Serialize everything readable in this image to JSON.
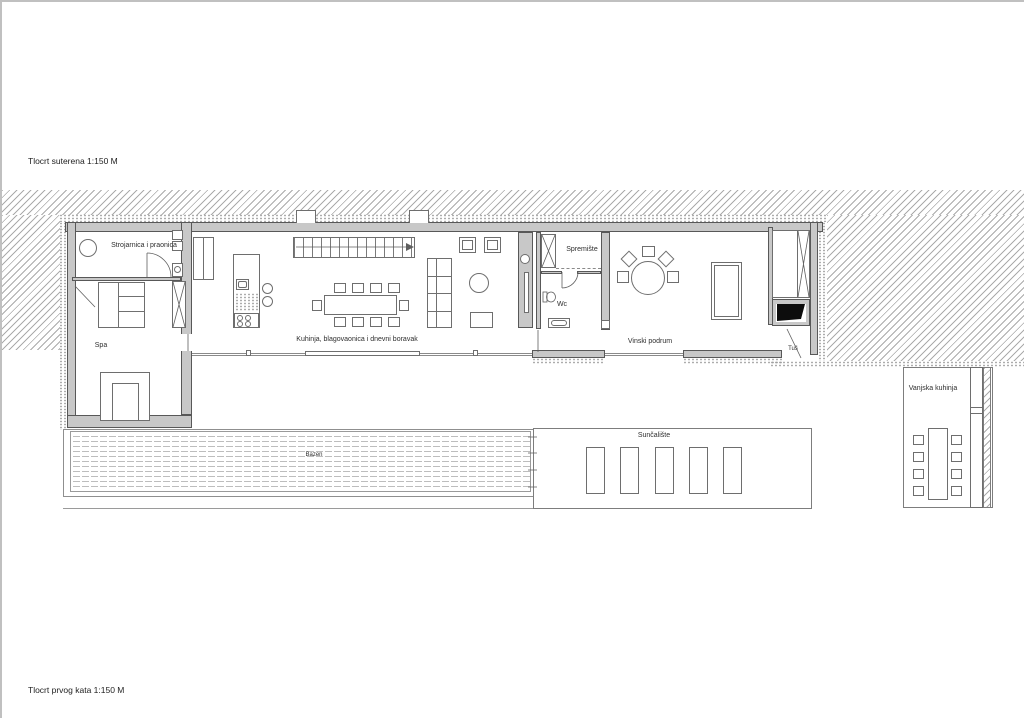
{
  "drawing": {
    "title_top": "Tlocrt suterena 1:150 M",
    "title_bottom": "Tlocrt prvog kata 1:150 M"
  },
  "labels": {
    "laundry": "Strojarnica i praonica",
    "spa": "Spa",
    "living": "Kuhinja, blagovaonica i dnevni boravak",
    "storage": "Spremište",
    "wc": "Wc",
    "wine_cellar": "Vinski podrum",
    "shower": "Tuš",
    "outdoor_kitchen": "Vanjska kuhinja",
    "pool": "Bazen",
    "sun_deck": "Sunčalište"
  },
  "colors": {
    "wall_fill": "#c8c8c8",
    "line": "#6e6e6e",
    "hatch": "#ababab",
    "text": "#2e2e2e",
    "background": "#ffffff"
  }
}
